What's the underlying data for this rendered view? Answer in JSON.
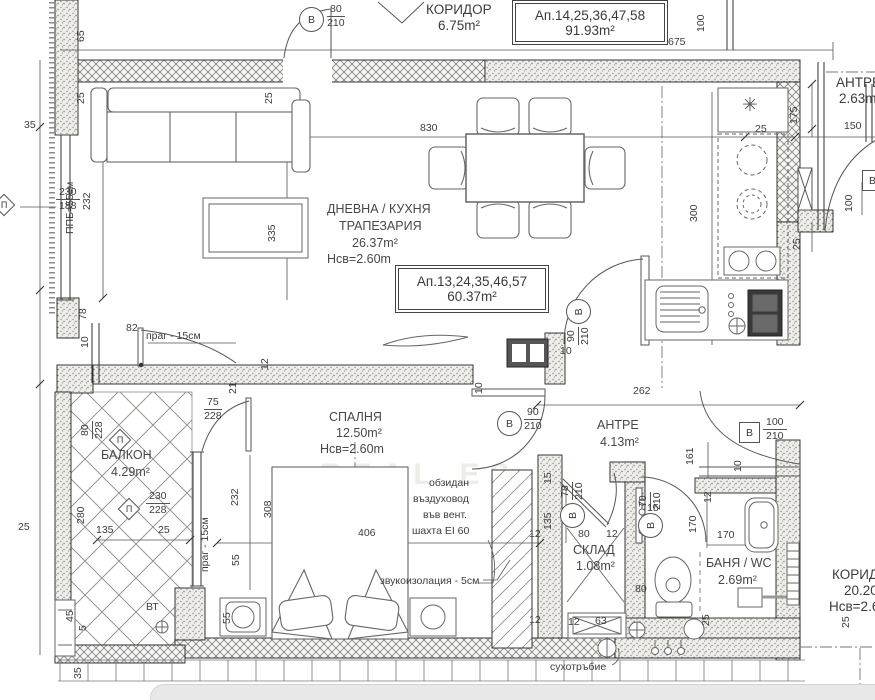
{
  "rooms": {
    "corridor_top": {
      "name": "КОРИДОР",
      "area": "6.75m²"
    },
    "living": {
      "name1": "ДНЕВНА / КУХНЯ",
      "name2": "ТРАПЕЗАРИЯ",
      "area": "26.37m²",
      "height": "Нсв=2.60m"
    },
    "bedroom": {
      "name": "СПАЛНЯ",
      "area": "12.50m²",
      "height": "Нсв=2.60m"
    },
    "antre": {
      "name": "АНТРЕ",
      "area": "4.13m²"
    },
    "balcony": {
      "name": "БАЛКОН",
      "area": "4.29m²"
    },
    "storage": {
      "name": "СКЛАД",
      "area": "1.08m²"
    },
    "bath": {
      "name": "БАНЯ / WC",
      "area": "2.69m²"
    },
    "antre_right": {
      "name": "АНТРЕ",
      "area": "2.63m²"
    },
    "corridor_right": {
      "name": "КОРИДОР",
      "area": "20.20m²",
      "height": "Нсв=2.60m"
    }
  },
  "boxes": {
    "upper": {
      "l1": "Ап.14,25,36,47,58",
      "l2": "91.93m²"
    },
    "main": {
      "l1": "Ап.13,24,35,46,57",
      "l2": "60.37m²"
    }
  },
  "badges": {
    "top": {
      "letter": "В",
      "num": "80",
      "den": "210"
    },
    "living_antre": {
      "letter": "В",
      "num": "90",
      "den": "210"
    },
    "antre": {
      "letter": "В",
      "num": "90",
      "den": "210"
    },
    "entry": {
      "letter": "В",
      "num": "100",
      "den": "210"
    },
    "sklad": {
      "letter": "В",
      "num": "78",
      "den": "210"
    },
    "bath": {
      "letter": "В",
      "num": "70",
      "den": "210"
    },
    "right_edge": {
      "letter": "В",
      "num": "100"
    },
    "win_left": {
      "letter": "П",
      "num": "230",
      "den": "188"
    },
    "win_balc_top": {
      "letter": "П",
      "num": "80",
      "den": "228"
    },
    "win_balc_mid": {
      "letter": "П",
      "num": "230",
      "den": "228"
    },
    "bedroom_size": {
      "num": "75",
      "den": "228"
    }
  },
  "dims": {
    "d675": "675",
    "d100t": "100",
    "d65": "65",
    "d25a": "25",
    "d25b": "25",
    "d35a": "35",
    "d830": "830",
    "d25c": "25",
    "d150": "150",
    "d175": "175",
    "d25d": "25",
    "d100r": "100",
    "d300": "300",
    "d335": "335",
    "d232a": "232",
    "d78a": "78",
    "d10a": "10",
    "d82": "82",
    "d12a": "12",
    "d21": "21",
    "d280": "280",
    "d135a": "135",
    "d25e": "25",
    "d25f": "25",
    "d232b": "232",
    "d308": "308",
    "d406": "406",
    "d55a": "55",
    "d55b": "55",
    "d262": "262",
    "d10b": "10",
    "d10c": "10",
    "d161": "161",
    "d10d": "10",
    "d12b": "12",
    "d170a": "170",
    "d170b": "170",
    "d15a": "15",
    "d135b": "135",
    "d80a": "80",
    "d12c": "12",
    "d15b": "15",
    "d80b": "80",
    "d63": "63",
    "d12d": "12",
    "d12e": "12",
    "d12f": "12",
    "d25g": "25",
    "d25h": "25",
    "d45": "45",
    "d5": "5",
    "d35b": "35"
  },
  "notes": {
    "prag": "праг - 15см",
    "ppb": "ППБ=55см",
    "vent1": "обзидан",
    "vent2": "въздуховод",
    "vent3": "във вент.",
    "vent4": "шахта EI 60",
    "sound": "звукоизолация - 5см",
    "dry": "сухотръбие",
    "vt": "ВТ",
    "star": "✳",
    "watermark": "REAL ES"
  },
  "colors": {
    "wall_line": "#222222",
    "dim_line": "#555555",
    "ui_bar": "#e8e8e8"
  }
}
